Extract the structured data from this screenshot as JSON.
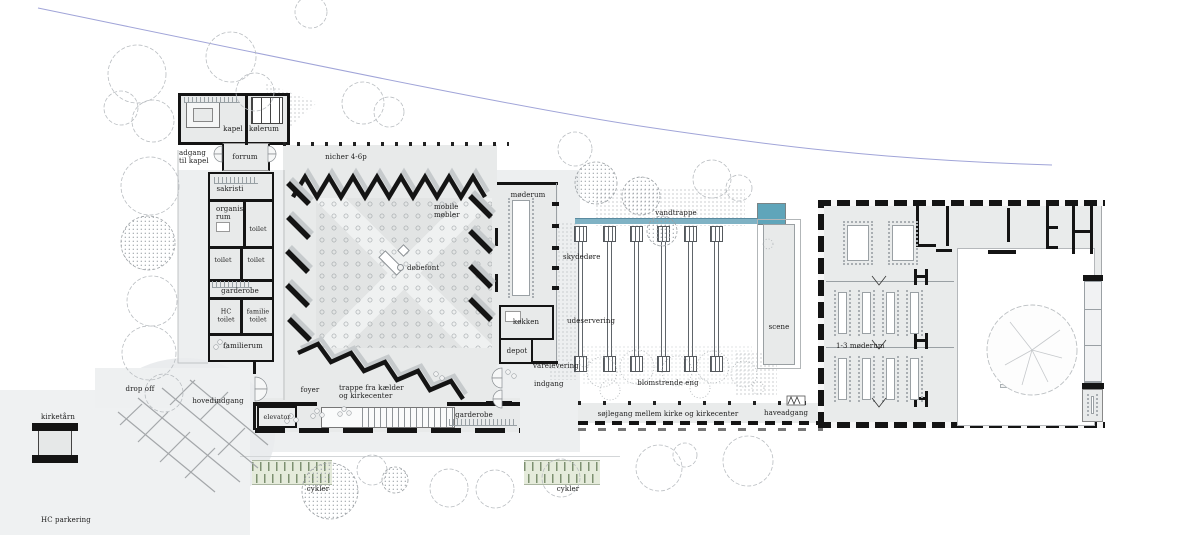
{
  "colors": {
    "wall": "#141414",
    "site_gray": "#edeff0",
    "building_gray": "#e8eaea",
    "water_bar": "#7fb2c4",
    "water_pool": "#5fa5ba",
    "bike_green": "#7d9070",
    "boundary_blue": "#a0a4d8"
  },
  "labels": {
    "chapel_wing": {
      "kapel": "kapel",
      "koelerum": "kølerum",
      "forrum": "forrum",
      "adgang_til_kapel": "adgang\ntil kapel",
      "sakristi": "sakristi",
      "organist_rum": "organist\nrum",
      "toilet_1": "toilet",
      "toilet_2": "toilet",
      "toilet_3": "toilet",
      "garderobe": "garderobe",
      "hc_toilet": "HC\ntoilet",
      "familie_toilet": "familie\ntoilet",
      "familierum": "familierum"
    },
    "church": {
      "nicher": "nicher 4-6p",
      "mobile_moebler": "mobile\nmøbler",
      "doebefont": "døbefont",
      "moederum": "møderum",
      "skydedoere": "skydedøre",
      "koekken": "køkken",
      "udeservering": "udeservering",
      "depot": "depot",
      "varelevering": "varelevering",
      "indgang": "indgang",
      "foyer": "foyer",
      "trappe": "trappe fra kælder\nog kirkecenter",
      "elevator": "elevator",
      "garderobe_foyer": "garderobe"
    },
    "garden": {
      "vandtrappe": "vandtrappe",
      "scene": "scene",
      "blomstrende_eng": "blomstrende eng",
      "soejlegang": "søjlegang mellem kirke og kirkecenter",
      "haveadgang": "haveadgang"
    },
    "kirkecenter": {
      "moederum_1_3": "1-3 møderum"
    },
    "site": {
      "kirketaarn": "kirketårn",
      "drop_off": "drop off",
      "hovedindgang": "hovedindgang",
      "hc_parkering": "HC parkering",
      "cykler_1": "cykler",
      "cykler_2": "cykler"
    }
  }
}
